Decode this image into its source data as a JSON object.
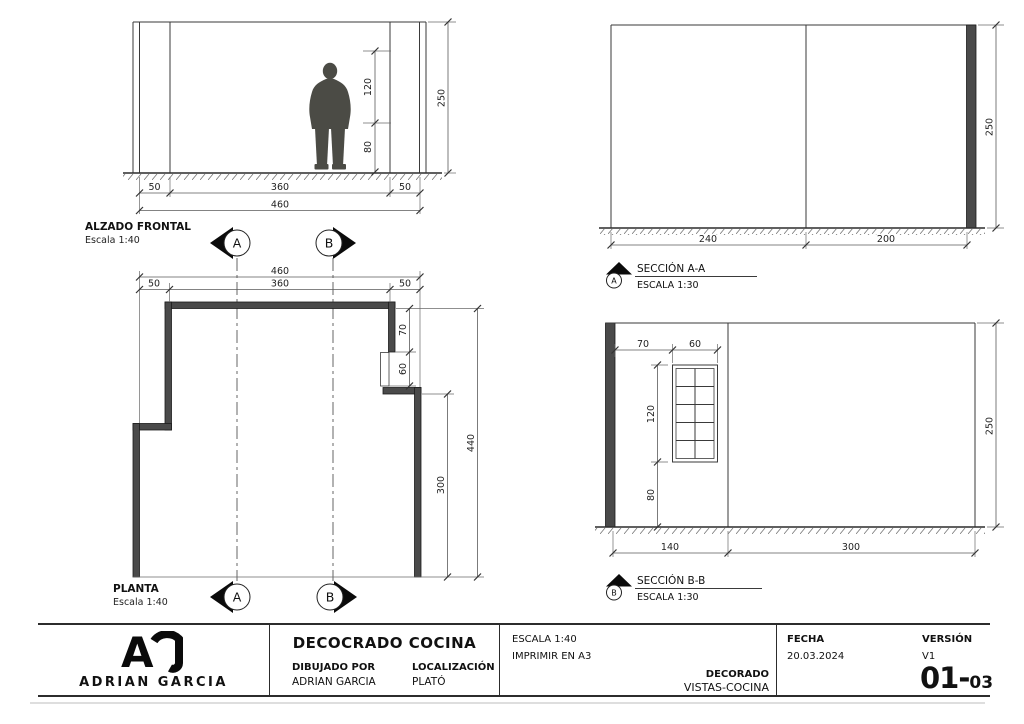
{
  "alzado": {
    "title": "ALZADO FRONTAL",
    "scale": "Escala 1:40",
    "dim_left": "50",
    "dim_span": "360",
    "dim_right": "50",
    "dim_total": "460",
    "dim_height": "250",
    "dim_upper": "120",
    "dim_lower": "80"
  },
  "seccion_aa": {
    "title": "SECCIÓN A-A",
    "scale": "ESCALA 1:30",
    "marker": "A",
    "dim_left": "240",
    "dim_right": "200",
    "dim_height": "250"
  },
  "planta": {
    "title": "PLANTA",
    "scale": "Escala 1:40",
    "marker_a": "A",
    "marker_b": "B",
    "dim_total": "460",
    "dim_span": "360",
    "dim_left": "50",
    "dim_right": "50",
    "dim_top_right": "70",
    "dim_opening": "60",
    "dim_bottom_right": "300",
    "dim_depth": "440"
  },
  "seccion_bb": {
    "title": "SECCIÓN B-B",
    "scale": "ESCALA 1:30",
    "marker": "B",
    "dim_wall_window": "70",
    "dim_window_w": "60",
    "dim_window_h": "120",
    "dim_sill": "80",
    "dim_height": "250",
    "dim_floor_left": "140",
    "dim_floor_right": "300"
  },
  "title_block": {
    "logo_letter": "A",
    "logo_name": "ADRIAN GARCIA",
    "project_title": "DECOCRADO COCINA",
    "drawn_by_label": "DIBUJADO POR",
    "drawn_by": "ADRIAN GARCIA",
    "location_label": "LOCALIZACIÓN",
    "location": "PLATÓ",
    "scale_note": "ESCALA 1:40",
    "print_note": "IMPRIMIR EN A3",
    "set_label": "DECORADO",
    "set_name": "VISTAS-COCINA",
    "date_label": "FECHA",
    "date": "20.03.2024",
    "version_label": "VERSIÓN",
    "version": "V1",
    "sheet_prefix": "01-",
    "sheet_suffix": "03"
  }
}
